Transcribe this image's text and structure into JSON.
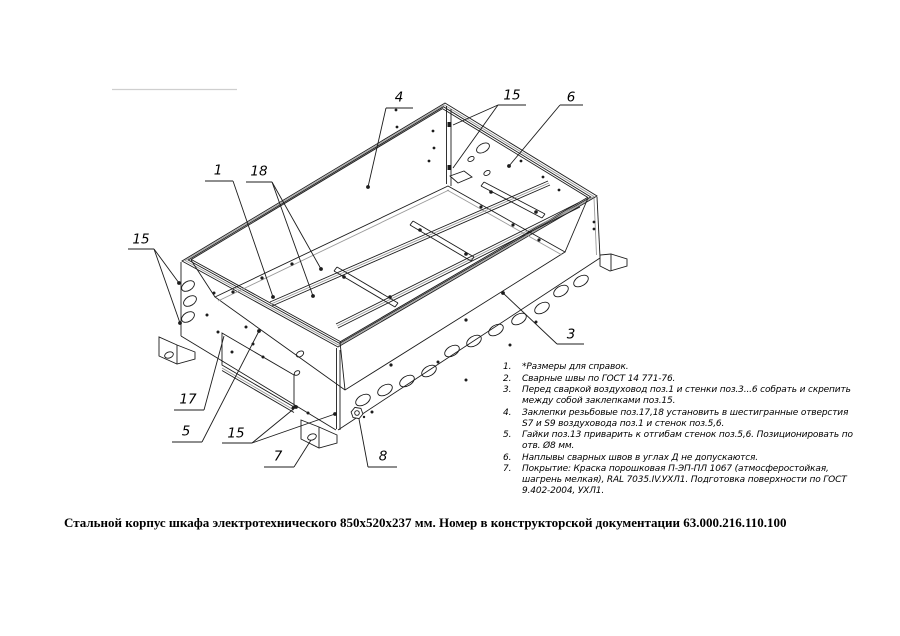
{
  "colors": {
    "line": "#1c1c1c",
    "soft": "#9a9a9a",
    "faint": "#cfcfcf",
    "text": "#000000",
    "background": "#ffffff"
  },
  "drawing": {
    "callouts": [
      {
        "label": "4",
        "x": 399,
        "y": 97,
        "underline": [
          386,
          108,
          413,
          108
        ],
        "leaders": [
          [
            386,
            108,
            368,
            187
          ]
        ],
        "dots": [
          [
            368,
            187
          ]
        ]
      },
      {
        "label": "15",
        "x": 512,
        "y": 95,
        "underline": [
          498,
          105,
          526,
          105
        ],
        "leaders": [
          [
            498,
            105,
            453,
            125
          ],
          [
            498,
            105,
            453,
            168
          ]
        ],
        "dots": []
      },
      {
        "label": "6",
        "x": 571,
        "y": 97,
        "underline": [
          560,
          105,
          583,
          105
        ],
        "leaders": [
          [
            560,
            105,
            509,
            166
          ]
        ],
        "dots": [
          [
            509,
            166
          ]
        ]
      },
      {
        "label": "1",
        "x": 218,
        "y": 170,
        "underline": [
          205,
          181,
          233,
          181
        ],
        "leaders": [
          [
            233,
            181,
            273,
            297
          ]
        ],
        "dots": [
          [
            273,
            297
          ]
        ]
      },
      {
        "label": "18",
        "x": 259,
        "y": 171,
        "underline": [
          246,
          182,
          272,
          182
        ],
        "leaders": [
          [
            272,
            182,
            313,
            296
          ],
          [
            272,
            182,
            321,
            269
          ]
        ],
        "dots": [
          [
            313,
            296
          ],
          [
            321,
            269
          ]
        ]
      },
      {
        "label": "15",
        "x": 141,
        "y": 239,
        "underline": [
          128,
          249,
          154,
          249
        ],
        "leaders": [
          [
            154,
            249,
            179,
            283
          ],
          [
            154,
            249,
            180,
            323
          ]
        ],
        "dots": [
          [
            179,
            283
          ],
          [
            180,
            323
          ]
        ]
      },
      {
        "label": "17",
        "x": 188,
        "y": 399,
        "underline": [
          174,
          410,
          204,
          410
        ],
        "leaders": [
          [
            204,
            410,
            224,
            336
          ]
        ],
        "dots": []
      },
      {
        "label": "5",
        "x": 186,
        "y": 431,
        "underline": [
          172,
          442,
          202,
          442
        ],
        "leaders": [
          [
            202,
            442,
            259,
            331
          ]
        ],
        "dots": [
          [
            259,
            331
          ]
        ]
      },
      {
        "label": "15",
        "x": 236,
        "y": 433,
        "underline": [
          222,
          443,
          252,
          443
        ],
        "leaders": [
          [
            252,
            443,
            296,
            407
          ],
          [
            252,
            443,
            335,
            414
          ]
        ],
        "dots": [
          [
            296,
            407
          ],
          [
            335,
            414
          ]
        ]
      },
      {
        "label": "7",
        "x": 278,
        "y": 456,
        "underline": [
          264,
          467,
          294,
          467
        ],
        "leaders": [
          [
            294,
            467,
            311,
            440
          ]
        ],
        "dots": []
      },
      {
        "label": "8",
        "x": 383,
        "y": 456,
        "underline": [
          368,
          467,
          397,
          467
        ],
        "leaders": [
          [
            368,
            467,
            359,
            419
          ]
        ],
        "dots": []
      },
      {
        "label": "3",
        "x": 571,
        "y": 334,
        "underline": [
          557,
          344,
          584,
          344
        ],
        "leaders": [
          [
            557,
            344,
            503,
            293
          ]
        ],
        "dots": [
          [
            503,
            293
          ]
        ]
      }
    ]
  },
  "notes": {
    "items": [
      {
        "num": "1.",
        "text": "*Размеры для справок."
      },
      {
        "num": "2.",
        "text": "Сварные швы по ГОСТ 14 771-76."
      },
      {
        "num": "3.",
        "text": "Перед сваркой воздуховод поз.1 и стенки поз.3...6 собрать и скрепить между собой заклепками поз.15."
      },
      {
        "num": "4.",
        "text": "Заклепки резьбовые поз.17,18 установить в шестигранные отверстия S7 и S9 воздуховода поз.1 и стенок поз.5,6."
      },
      {
        "num": "5.",
        "text": "Гайки поз.13 приварить к отгибам стенок поз.5,6. Позиционировать по отв. Ø8 мм."
      },
      {
        "num": "6.",
        "text": "Наплывы сварных швов в углах Д не допускаются."
      },
      {
        "num": "7.",
        "text": "Покрытие: Краска порошковая П-ЭП-ПЛ 1067 (атмосферостойкая, шагрень мелкая), RAL 7035.IV.УХЛ1. Подготовка поверхности по ГОСТ 9.402-2004, УХЛ1."
      }
    ]
  },
  "caption": {
    "text": "Стальной корпус шкафа электротехнического 850х520х237 мм. Номер в конструкторской документации 63.000.216.110.100"
  }
}
